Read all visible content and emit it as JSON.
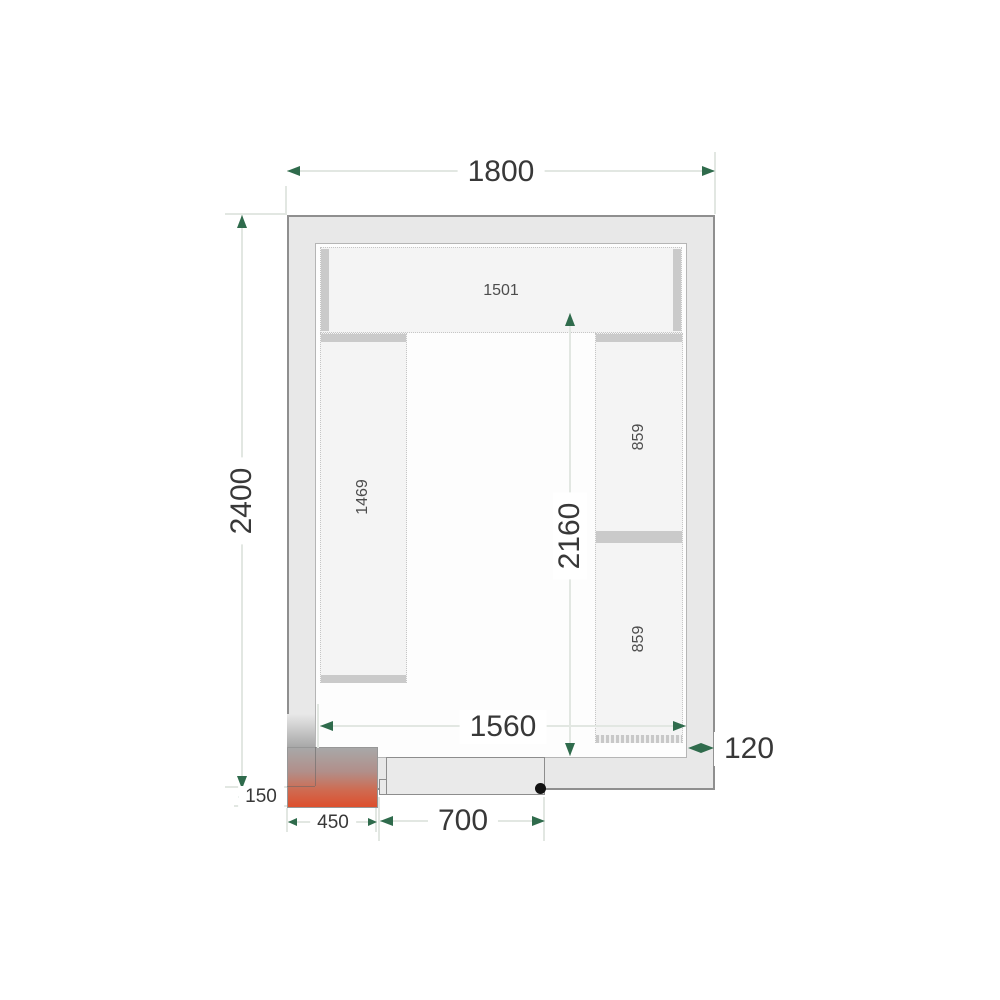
{
  "drawing": {
    "type": "cold-room floor plan",
    "dims": {
      "overall_width": "1800",
      "overall_depth": "2400",
      "interior_depth": "2160",
      "interior_width": "1560",
      "panel_thickness": "120",
      "door_opening": "700",
      "corner_unit_width": "450",
      "corner_unit_offset": "150"
    },
    "shelves": {
      "top_length": "1501",
      "left_length": "1469",
      "right_upper_length": "859",
      "right_lower_length": "859"
    },
    "colors": {
      "wall_fill": "#e8e8e8",
      "wall_outline": "#8f8f8f",
      "shelf_fill": "#f4f4f4",
      "shelf_edge": "#cacaca",
      "dimension_line": "#e2e7e2",
      "dimension_arrow": "#2f6b4c",
      "dimension_text": "#383838",
      "unit_gradient_top": "#a8a8a8",
      "unit_gradient_bottom": "#dd4f2d",
      "hinge_dot": "#121212"
    }
  }
}
